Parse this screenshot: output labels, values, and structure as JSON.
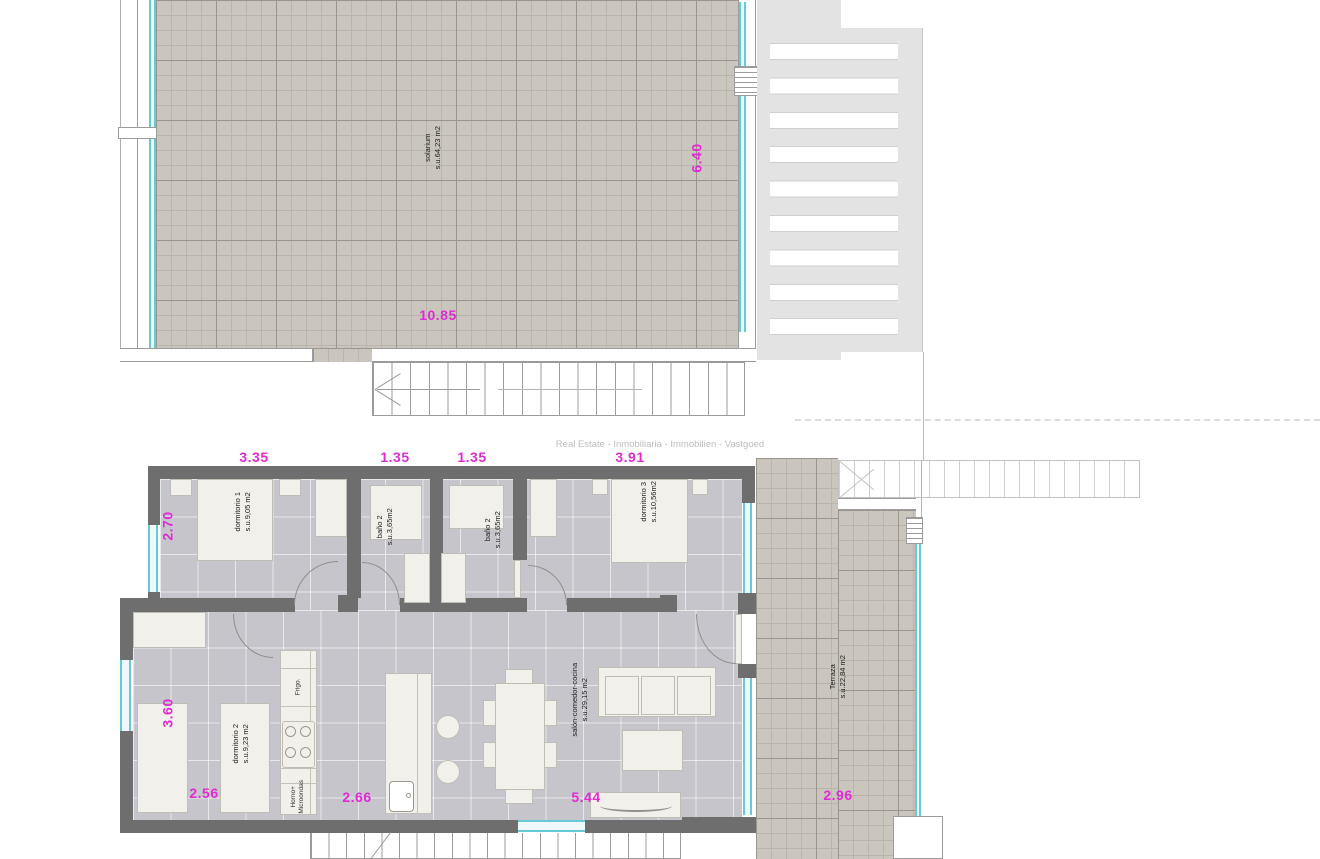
{
  "watermark": "Real Estate - Inmobiliaria - Immobilien - Vastgoed",
  "colors": {
    "dimension_text": "#e02ad4",
    "glass": "#66cad5",
    "wall": "#6e6e6e",
    "outdoor_tile": "#cac6bd",
    "indoor_floor": "#c5c5cb",
    "pergola": "#e3e3e3"
  },
  "rooms": {
    "solarium": {
      "name": "solarium",
      "area": "s.u.64,23 m2"
    },
    "dormitorio1": {
      "name": "dormitorio 1",
      "area": "s.u.9,05 m2"
    },
    "bano_left": {
      "name": "baño 2",
      "area": "s.u.3,65m2"
    },
    "bano_right": {
      "name": "baño 2",
      "area": "s.u.3,65m2"
    },
    "dormitorio3": {
      "name": "dormitorio 3",
      "area": "s.u.10,56m2"
    },
    "dormitorio2": {
      "name": "dormitorio 2",
      "area": "s.u.9,23 m2"
    },
    "salon": {
      "name": "salón-comedor-cocina",
      "area": "s.u.29,15 m2"
    },
    "terraza": {
      "name": "Terraza",
      "area": "s.u.22,84 m2"
    }
  },
  "kitchen": {
    "fridge": "Frigo.",
    "oven_line1": "Horno+",
    "oven_line2": "Microondas"
  },
  "dimensions": {
    "solarium_width": "10.85",
    "solarium_depth": "6.40",
    "dorm1_width": "3.35",
    "bath_left_width": "1.35",
    "bath_right_width": "1.35",
    "dorm3_width": "3.91",
    "dorm1_depth": "2.70",
    "dorm2_depth": "3.60",
    "dorm2_width": "2.56",
    "kitchen_width": "2.66",
    "salon_width": "5.44",
    "terraza_width": "2.96"
  }
}
